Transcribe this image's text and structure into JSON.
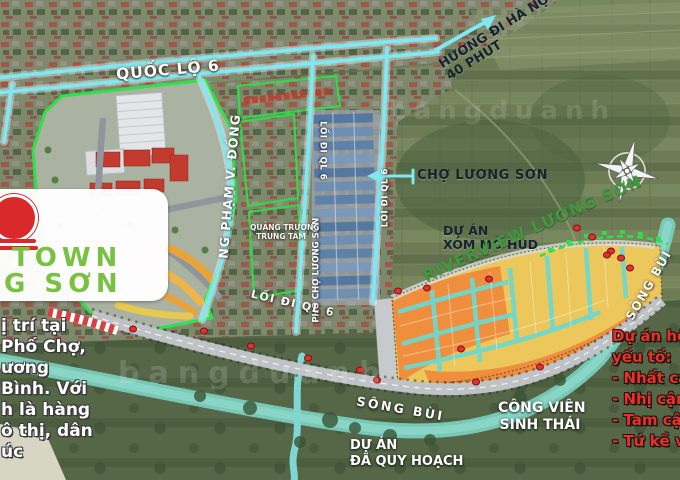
{
  "colors": {
    "road_highlight_cyan": "#7ee9f2",
    "project_outline_green": "#2ee04a",
    "riverview_text_green": "#3f9a3c",
    "logo_green": "#7ac143",
    "logo_red": "#d9292b",
    "right_caption_red": "#ef2f23",
    "lot_orange": "#ef8f3e",
    "lot_yellow": "#ecc75b",
    "market_roof_blue": "#5d80ab",
    "river_teal": "#79cdbd",
    "marker_red": "#e03131"
  },
  "map": {
    "roads": {
      "quoc_lo_6": "QUỐC LỘ 6",
      "huong_di_ha_noi": "HƯỚNG ĐI HÀ NỘI",
      "duration": "40 PHÚT",
      "pham_van_dong": "NG PHẠM V. ĐỒNG",
      "loi_di_ql6_top": "LỐI ĐI QL 6",
      "loi_di_ql6_right": "LỐI ĐI QL 6",
      "loi_di_ql6_main": "LỐI ĐI QL 6",
      "pho_cho_luong_son": "PHỐ CHỢ LƯƠNG SƠN",
      "quang_truong_l1": "QUẢNG TRƯỜNG",
      "quang_truong_l2": "TRUNG TÂM"
    },
    "places": {
      "market": "CHỢ LƯƠNG SƠN",
      "hud_l1": "DỰ ÁN",
      "hud_l2": "XÓM MỎ HUD",
      "riverview": "RIVERVIEW LƯƠNG SƠN",
      "park_l1": "CÔNG VIÊN",
      "park_l2": "SINH THÁI",
      "planned_l1": "DỰ ÁN",
      "planned_l2": "ĐÃ QUY HOẠCH",
      "river_main": "SÔNG BÙI",
      "river_side": "SÔNG BÙI"
    },
    "logo": {
      "l1": "TOWN",
      "l2": "G SƠN"
    },
    "caption_left": {
      "l1": "ị trí tại",
      "l2": "Phố Chợ,",
      "l3": "ương",
      "l4": "Bình. Với",
      "l5": "h là hàng",
      "l6": "ô thị, dân",
      "l7": "úc"
    },
    "caption_right": {
      "l1": "Dự án hội",
      "l2": "yếu tố:",
      "l3": "- Nhất cận",
      "l4": "- Nhị cận",
      "l5": "- Tam cận",
      "l6": "- Tứ kề vư"
    },
    "watermark": "bangduanh"
  }
}
